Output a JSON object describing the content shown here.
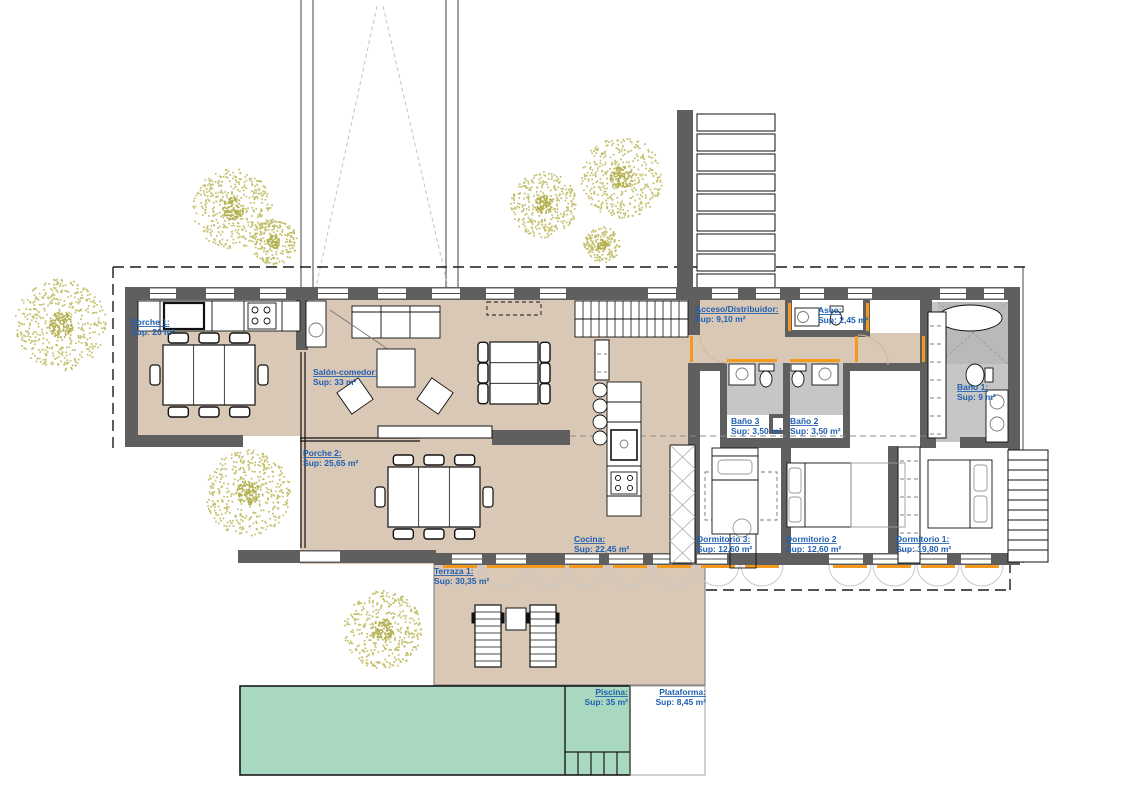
{
  "drawing": {
    "title": "Planta vivienda (floor plan)",
    "rooms": {
      "porche1": {
        "name": "Porche 1:",
        "sup": "Sup:  20 m²"
      },
      "salon": {
        "name": "Salón-comedor:",
        "sup": "Sup:  33 m²"
      },
      "porche2": {
        "name": "Porche 2:",
        "sup": "Sup:  25,65 m²"
      },
      "acceso": {
        "name": "Acceso/Distribuidor:",
        "sup": "Sup:  9,10 m²"
      },
      "aseo": {
        "name": "Aseo:",
        "sup": "Sup:  2,45 m²"
      },
      "bano3": {
        "name": "Baño 3",
        "sup": "Sup:  3,50 m²"
      },
      "bano2": {
        "name": "Baño 2",
        "sup": "Sup:  3,50 m²"
      },
      "bano1": {
        "name": "Baño 1:",
        "sup": "Sup:  9 m²"
      },
      "cocina": {
        "name": "Cocina:",
        "sup": "Sup:  22,45 m²"
      },
      "dormitorio3": {
        "name": "Dormitorio 3:",
        "sup": "Sup:  12,60 m²"
      },
      "dormitorio2": {
        "name": "Dormitorio 2",
        "sup": "Sup:  12,60 m²"
      },
      "dormitorio1": {
        "name": "Dormitorio 1:",
        "sup": "Sup:  19,80 m²"
      },
      "terraza": {
        "name": "Terraza 1:",
        "sup": "Sup:  30,35 m²"
      },
      "piscina": {
        "name": "Piscina:",
        "sup": "Sup:  35 m²"
      },
      "plataforma": {
        "name": "Plataforma:",
        "sup": "Sup:  8,45 m²"
      }
    },
    "colors": {
      "floor_beige": "#d9c8b6",
      "wall_gray": "#5f5f5f",
      "bath_gray": "#c6c6c6",
      "pool_green": "#a8d8bf",
      "label_blue": "#1f5fb0",
      "accent_orange": "#f5991e",
      "tree_olive": "#c3bf6a"
    }
  }
}
